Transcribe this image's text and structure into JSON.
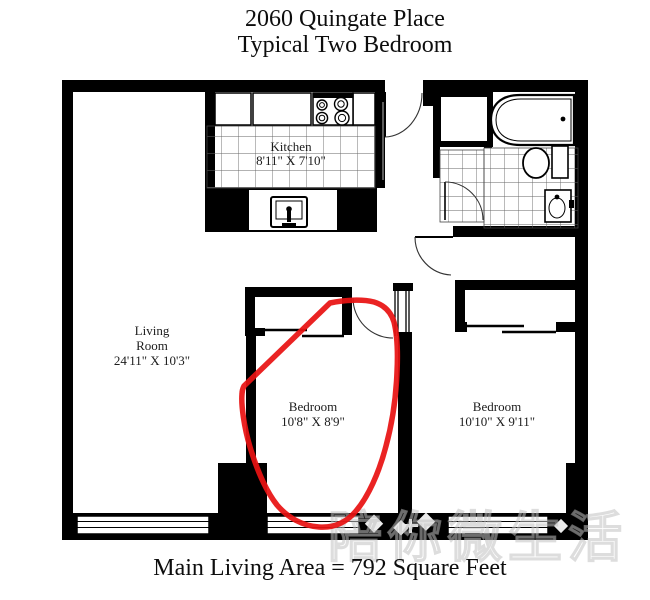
{
  "title": {
    "line1": "2060 Quingate Place",
    "line2": "Typical Two Bedroom"
  },
  "footer": {
    "text": "Main Living Area = 792 Square Feet"
  },
  "rooms": {
    "kitchen": {
      "name": "Kitchen",
      "dims": "8'11\" X 7'10\""
    },
    "living": {
      "name_line1": "Living",
      "name_line2": "Room",
      "dims": "24'11\" X 10'3\""
    },
    "bedroom1": {
      "name": "Bedroom",
      "dims": "10'8\" X 8'9\""
    },
    "bedroom2": {
      "name": "Bedroom",
      "dims": "10'10\" X 9'11\""
    }
  },
  "annotation": {
    "type": "freehand-circle",
    "target": "bedroom1",
    "color": "#e81212"
  },
  "watermark": {
    "text": "陪你微生活"
  },
  "colors": {
    "walls": "#000000",
    "background": "#ffffff",
    "annotation": "#e81212",
    "tile_lines": "#666666"
  }
}
